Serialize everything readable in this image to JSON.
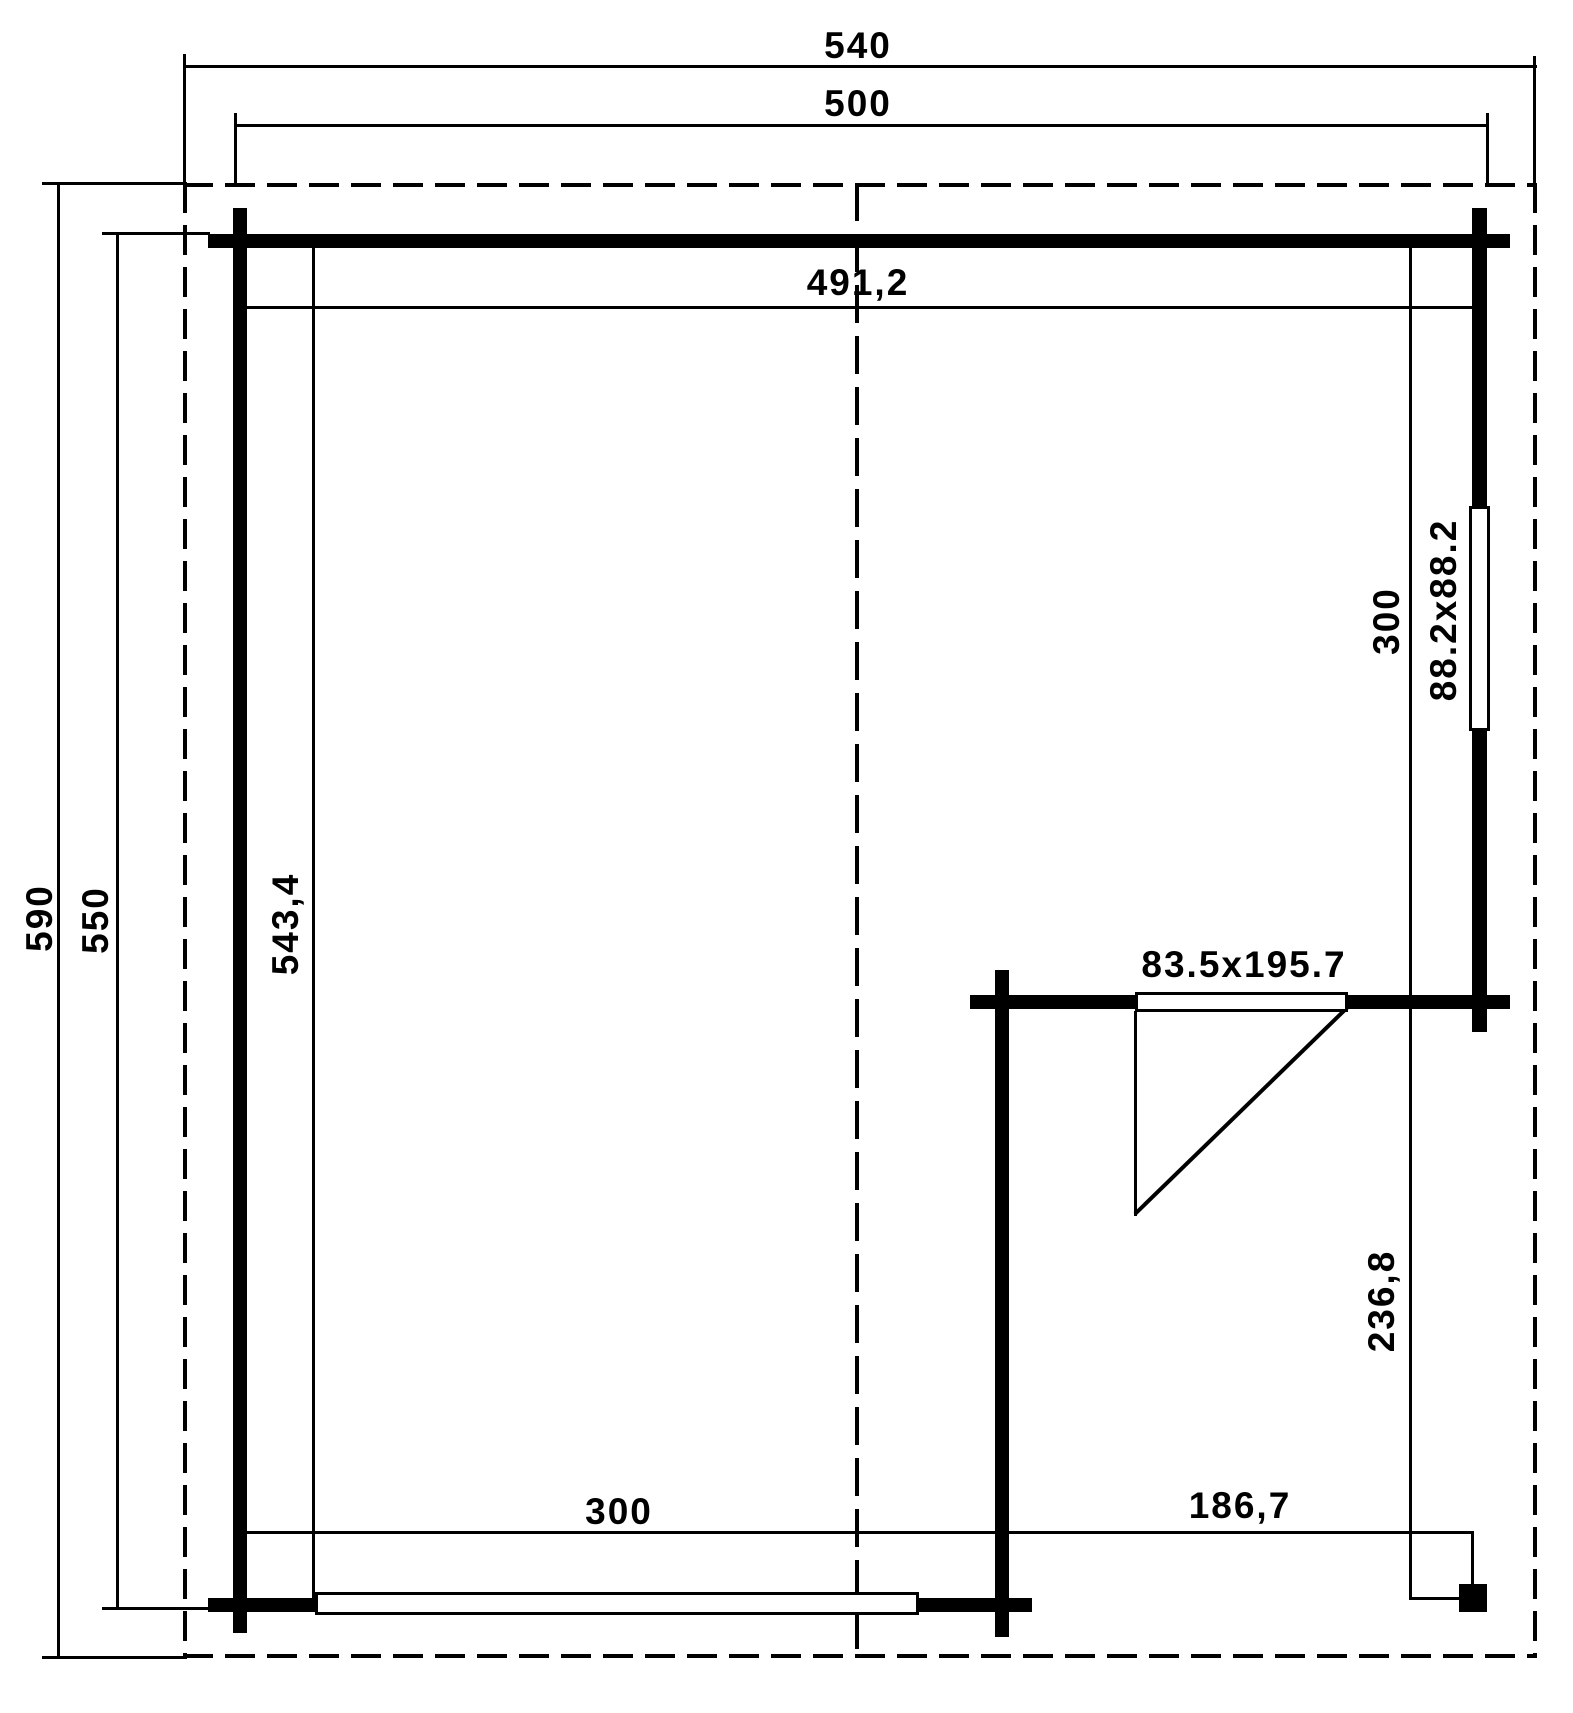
{
  "drawing": {
    "kind": "log-cabin floor plan with covered terrace",
    "units_shown": "cm"
  },
  "colors": {
    "ink": "#000000",
    "paper": "#ffffff"
  },
  "dimensions": {
    "roof_width": "540",
    "outer_width": "500",
    "inner_width": "491,2",
    "roof_depth": "590",
    "outer_depth": "550",
    "inner_depth": "543,4",
    "room_depth_right": "300",
    "window_right_size": "88.2x88.2",
    "door_size": "83.5x195.7",
    "terrace_depth": "236,8",
    "room_width_bottom": "300",
    "terrace_width": "186,7"
  }
}
